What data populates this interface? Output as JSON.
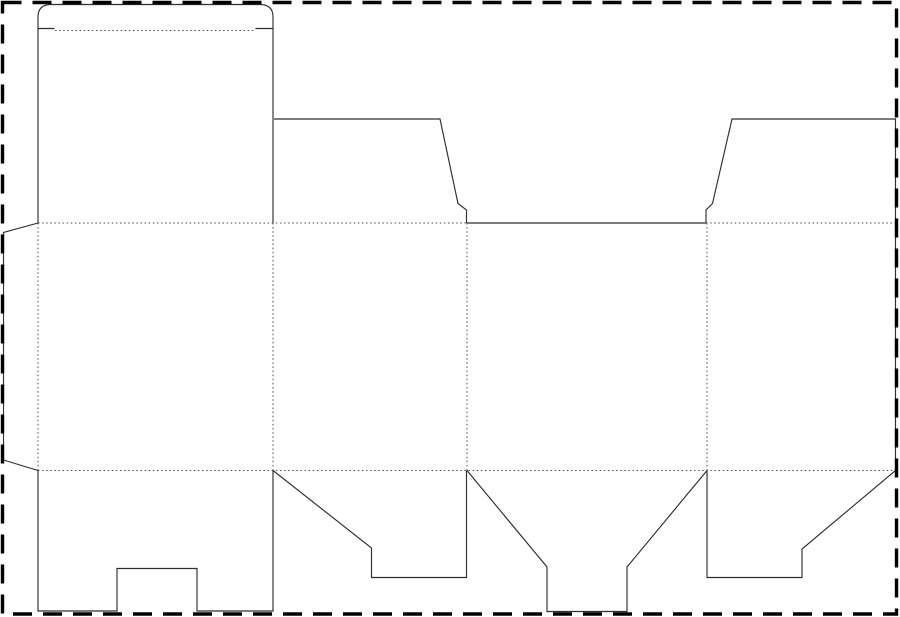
{
  "canvas": {
    "width": 900,
    "height": 617,
    "background": "#ffffff"
  },
  "border": {
    "name": "artboard-dashed-border",
    "x": 2.5,
    "y": 2.5,
    "width": 894,
    "height": 611.5,
    "stroke": "#000000",
    "stroke_width": 3.4,
    "dash": "19 11"
  },
  "dieline": {
    "cut_color": "#2f2f2f",
    "cut_width": 1.15,
    "fold_color": "#4d4d4d",
    "fold_width": 1,
    "fold_dash": "1.5 2.6",
    "cut_paths": [
      {
        "name": "back-panel-and-tuck-lid-outline",
        "d": "M 38 223 L 38 17 Q 38 4.5 51 4.5 L 260 4.5 Q 273 4.5 273 17 L 273 223"
      },
      {
        "name": "tuck-lid-left-shoulder-cut",
        "d": "M 38 28.5 L 54.5 28.5"
      },
      {
        "name": "tuck-lid-right-shoulder-cut",
        "d": "M 255.5 28.5 L 273 28.5"
      },
      {
        "name": "top-dust-flap-left-outline",
        "d": "M 274 119 L 440 119 L 458 203.5 L 466.5 210 L 466.5 223"
      },
      {
        "name": "front-panel-top-cut-edge",
        "d": "M 467 223 L 706 223"
      },
      {
        "name": "top-dust-flap-right-outline-and-right-edge",
        "d": "M 706 223 L 706 210 L 712.5 203.5 L 732 119 L 895.5 119 L 895.5 470.5"
      },
      {
        "name": "glue-flap-outline",
        "d": "M 38 223 L 3.5 232.5 L 3.5 460 L 38 470.5"
      },
      {
        "name": "bottom-lock-flap-1-outline",
        "d": "M 38 470.5 L 38 611 L 117 611 L 117 568.5 L 197 568.5 L 197 611 L 273 611 L 273 470.5"
      },
      {
        "name": "bottom-dust-flap-2-outline",
        "d": "M 273 470.5 L 371.5 548 L 371.5 577.5 L 466.5 577.5 L 466.5 470.5"
      },
      {
        "name": "bottom-tongue-flap-3-outline",
        "d": "M 467 470.5 L 547 567 L 547 611.5 L 627 611.5 L 627 567 L 707 470.5"
      },
      {
        "name": "bottom-dust-flap-4-outline",
        "d": "M 707 470.5 L 707 577.5 L 802 577.5 L 802 549 L 895.5 470.5"
      }
    ],
    "fold_lines": [
      {
        "name": "tuck-lid-fold",
        "x1": 55,
        "y1": 30.5,
        "x2": 255,
        "y2": 30.5
      },
      {
        "name": "top-horizontal-fold-left-section",
        "x1": 38,
        "y1": 223,
        "x2": 466.5,
        "y2": 223
      },
      {
        "name": "top-horizontal-fold-right-section",
        "x1": 706,
        "y1": 223,
        "x2": 895.5,
        "y2": 223
      },
      {
        "name": "bottom-horizontal-fold",
        "x1": 38,
        "y1": 470.5,
        "x2": 895.5,
        "y2": 470.5
      },
      {
        "name": "glue-flap-fold",
        "x1": 38,
        "y1": 223,
        "x2": 38,
        "y2": 470.5
      },
      {
        "name": "panel-1-2-fold",
        "x1": 273,
        "y1": 223,
        "x2": 273,
        "y2": 470.5
      },
      {
        "name": "panel-2-3-fold",
        "x1": 467,
        "y1": 223,
        "x2": 467,
        "y2": 470.5
      },
      {
        "name": "panel-3-4-fold",
        "x1": 707,
        "y1": 223,
        "x2": 707,
        "y2": 470.5
      }
    ]
  }
}
